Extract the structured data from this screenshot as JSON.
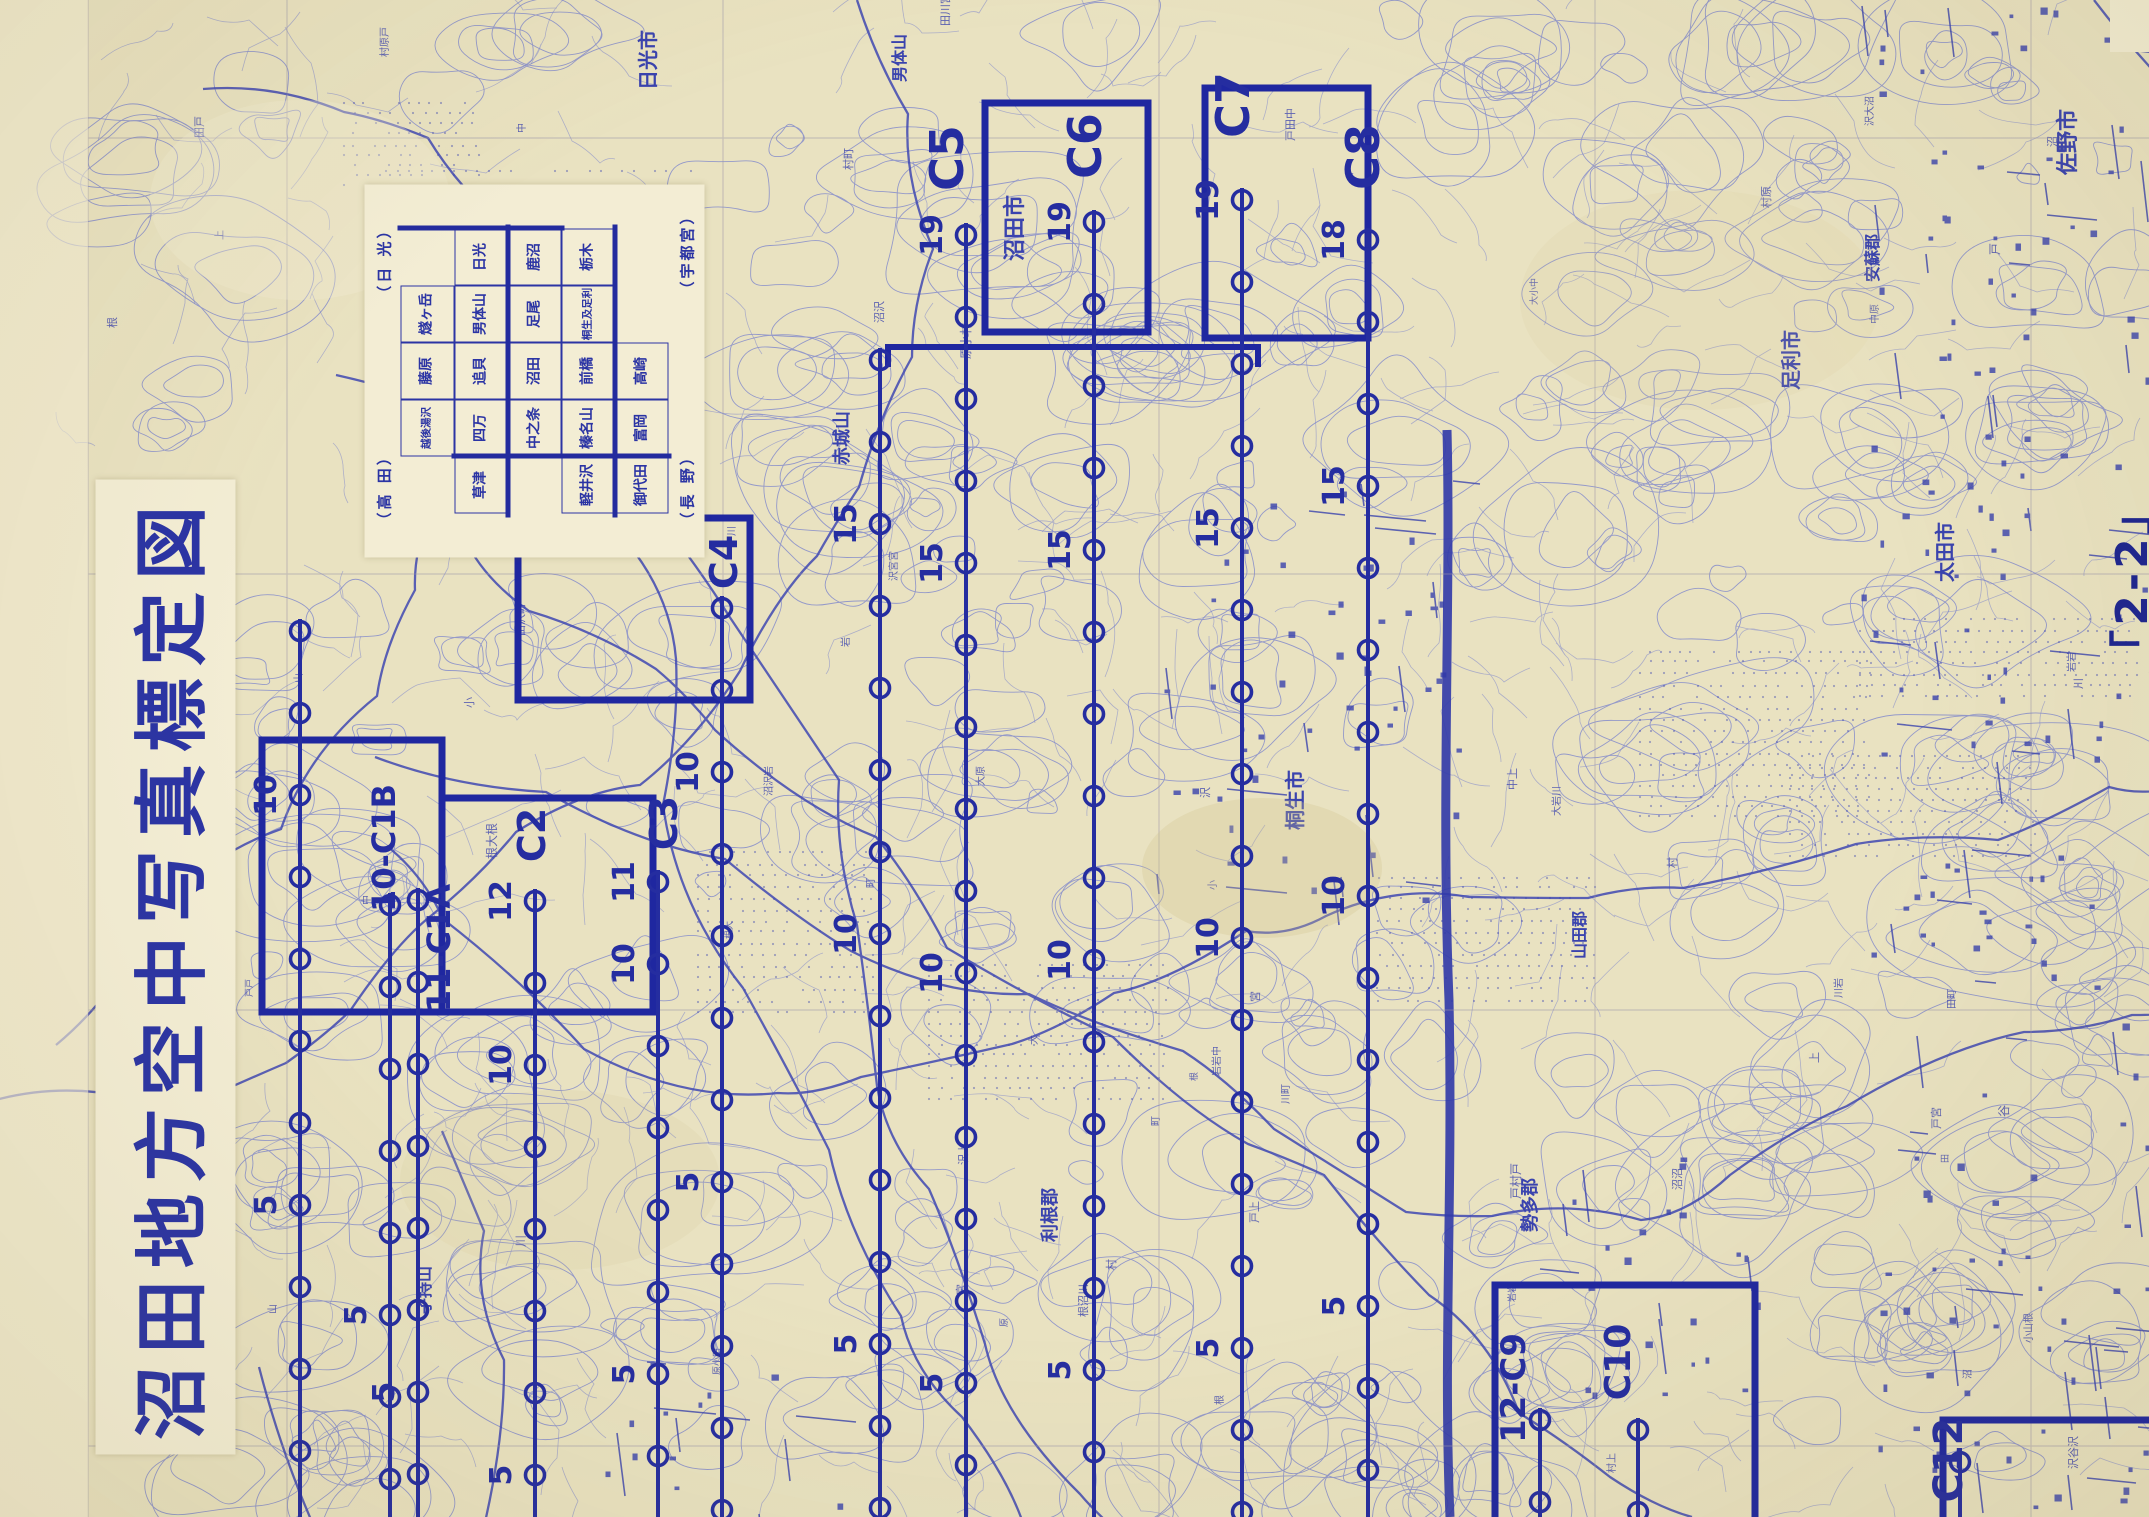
{
  "title": {
    "text": "沼田地方空中写真標定図"
  },
  "page_label": "「2-2」",
  "index_panel": {
    "corner_labels": {
      "tl": "（高 田）",
      "tr": "（日 光）",
      "bl": "（長 野）",
      "br": "（宇都宮）"
    },
    "grid": {
      "rows": [
        [
          "",
          "越後湯沢",
          "藤原",
          "燧ヶ岳",
          ""
        ],
        [
          "草津",
          "四万",
          "追貝",
          "男体山",
          "日光"
        ],
        [
          "",
          "中之条",
          "沼田",
          "足尾",
          "鹿沼"
        ],
        [
          "軽井沢",
          "榛名山",
          "前橋",
          "桐生及足利",
          "栃木"
        ],
        [
          "御代田",
          "富岡",
          "高崎",
          "",
          ""
        ]
      ]
    }
  },
  "colors": {
    "paper": "#e9e2c1",
    "panel_paper": "#f3edd4",
    "contour_light": "#7d85cc",
    "map_blue": "#4049b2",
    "symbol_blue": "#3a43ae",
    "flight_navy": "#252da0",
    "block_navy": "#1f27a0",
    "neatline_gray": "#9a94a8",
    "title_navy": "#2b34a4"
  },
  "flight_lines": [
    {
      "id": "C1",
      "x": 300,
      "ring0": 631,
      "label": null,
      "numbers": [
        {
          "t": "10",
          "y": 795
        },
        {
          "t": "5",
          "y": 1205
        }
      ]
    },
    {
      "id": "C1B",
      "x": 390,
      "ring0": 905,
      "label": {
        "text": "10-C1B",
        "cx": 395,
        "cy": 848,
        "size": 32
      },
      "numbers": [
        {
          "t": "5",
          "y": 1315
        }
      ]
    },
    {
      "id": "C1A",
      "x": 418,
      "ring0": 900,
      "label": {
        "text": "11-C1A",
        "cx": 450,
        "cy": 948,
        "size": 32
      },
      "numbers": [
        {
          "t": "5",
          "y": 1392
        }
      ]
    },
    {
      "id": "C2",
      "x": 535,
      "ring0": 901,
      "label": {
        "text": "C2",
        "cx": 545,
        "cy": 835,
        "size": 38
      },
      "numbers": [
        {
          "t": "12",
          "y": 901
        },
        {
          "t": "10",
          "y": 1065
        },
        {
          "t": "5",
          "y": 1475
        }
      ]
    },
    {
      "id": "C3",
      "x": 658,
      "ring0": 882,
      "label": {
        "text": "C3",
        "cx": 677,
        "cy": 823,
        "size": 38
      },
      "numbers": [
        {
          "t": "11",
          "y": 882
        },
        {
          "t": "10",
          "y": 964
        },
        {
          "t": "5",
          "y": 1374
        }
      ]
    },
    {
      "id": "C4",
      "x": 722,
      "ring0": 608,
      "label": {
        "text": "C4",
        "cx": 737,
        "cy": 562,
        "size": 38
      },
      "numbers": [
        {
          "t": "10",
          "y": 772
        },
        {
          "t": "5",
          "y": 1182
        }
      ]
    },
    {
      "id": "LA",
      "x": 880,
      "ring0": 360,
      "label": null,
      "numbers": [
        {
          "t": "15",
          "y": 524
        },
        {
          "t": "10",
          "y": 934
        },
        {
          "t": "5",
          "y": 1344
        }
      ]
    },
    {
      "id": "C5",
      "x": 966,
      "ring0": 235,
      "label": {
        "text": "C5",
        "cx": 963,
        "cy": 158,
        "size": 46
      },
      "numbers": [
        {
          "t": "19",
          "y": 235
        },
        {
          "t": "15",
          "y": 563
        },
        {
          "t": "10",
          "y": 973
        },
        {
          "t": "5",
          "y": 1383
        }
      ]
    },
    {
      "id": "C6",
      "x": 1094,
      "ring0": 222,
      "label": {
        "text": "C6",
        "cx": 1101,
        "cy": 146,
        "size": 46
      },
      "numbers": [
        {
          "t": "19",
          "y": 222
        },
        {
          "t": "15",
          "y": 550
        },
        {
          "t": "10",
          "y": 960
        },
        {
          "t": "5",
          "y": 1370
        }
      ]
    },
    {
      "id": "C7",
      "x": 1242,
      "ring0": 200,
      "label": {
        "text": "C7",
        "cx": 1249,
        "cy": 105,
        "size": 46
      },
      "numbers": [
        {
          "t": "19",
          "y": 200
        },
        {
          "t": "15",
          "y": 528
        },
        {
          "t": "10",
          "y": 938
        },
        {
          "t": "5",
          "y": 1348
        }
      ]
    },
    {
      "id": "C8",
      "x": 1368,
      "ring0": 240,
      "label": {
        "text": "C8",
        "cx": 1379,
        "cy": 157,
        "size": 46
      },
      "numbers": [
        {
          "t": "18",
          "y": 240
        },
        {
          "t": "15",
          "y": 486
        },
        {
          "t": "10",
          "y": 896
        },
        {
          "t": "5",
          "y": 1306
        }
      ]
    },
    {
      "id": "C9",
      "x": 1540,
      "ring0": 1420,
      "label": {
        "text": "12-C9",
        "cx": 1525,
        "cy": 1388,
        "size": 34
      },
      "numbers": []
    },
    {
      "id": "C10",
      "x": 1638,
      "ring0": 1430,
      "label": {
        "text": "C10",
        "cx": 1630,
        "cy": 1362,
        "size": 36
      },
      "numbers": []
    },
    {
      "id": "C12",
      "x": 1960,
      "ring0": 1462,
      "label": {
        "text": "C12",
        "cx": 1962,
        "cy": 1460,
        "size": 40
      },
      "numbers": []
    }
  ],
  "blocks": [
    {
      "x": 262,
      "y": 740,
      "w": 180,
      "h": 272
    },
    {
      "x": 442,
      "y": 798,
      "w": 211,
      "h": 214
    },
    {
      "x": 518,
      "y": 518,
      "w": 232,
      "h": 182
    },
    {
      "x": 985,
      "y": 103,
      "w": 163,
      "h": 229
    },
    {
      "x": 1205,
      "y": 88,
      "w": 163,
      "h": 250
    },
    {
      "x": 1495,
      "y": 1285,
      "w": 260,
      "h": 250
    },
    {
      "x": 1943,
      "y": 1420,
      "w": 210,
      "h": 115
    }
  ],
  "block_segments": [
    {
      "x1": 888,
      "y1": 347,
      "x2": 1258,
      "y2": 347,
      "tick": 20
    }
  ],
  "map_frame": {
    "neatline_xs": [
      88,
      287,
      723,
      1159,
      1595,
      2031
    ],
    "neatline_ys": [
      138,
      574,
      1010,
      1446
    ],
    "thick_road_x": 1447
  },
  "places": [
    {
      "t": "日光市",
      "x": 655,
      "y": 60,
      "s": 20
    },
    {
      "t": "沼田市",
      "x": 1022,
      "y": 228,
      "s": 22
    },
    {
      "t": "佐野市",
      "x": 2075,
      "y": 142,
      "s": 22
    },
    {
      "t": "足利市",
      "x": 1798,
      "y": 360,
      "s": 20
    },
    {
      "t": "桐生市",
      "x": 1302,
      "y": 800,
      "s": 20
    },
    {
      "t": "太田市",
      "x": 1952,
      "y": 552,
      "s": 20
    },
    {
      "t": "赤城山",
      "x": 848,
      "y": 438,
      "s": 18
    },
    {
      "t": "武尊山",
      "x": 562,
      "y": 300,
      "s": 18
    },
    {
      "t": "男体山",
      "x": 905,
      "y": 58,
      "s": 16
    },
    {
      "t": "利根郡",
      "x": 1056,
      "y": 1215,
      "s": 18
    },
    {
      "t": "勢多郡",
      "x": 1536,
      "y": 1205,
      "s": 18
    },
    {
      "t": "安蘇郡",
      "x": 1878,
      "y": 258,
      "s": 16
    },
    {
      "t": "山田郡",
      "x": 1585,
      "y": 935,
      "s": 16
    },
    {
      "t": "子持山",
      "x": 430,
      "y": 1290,
      "s": 16
    }
  ]
}
